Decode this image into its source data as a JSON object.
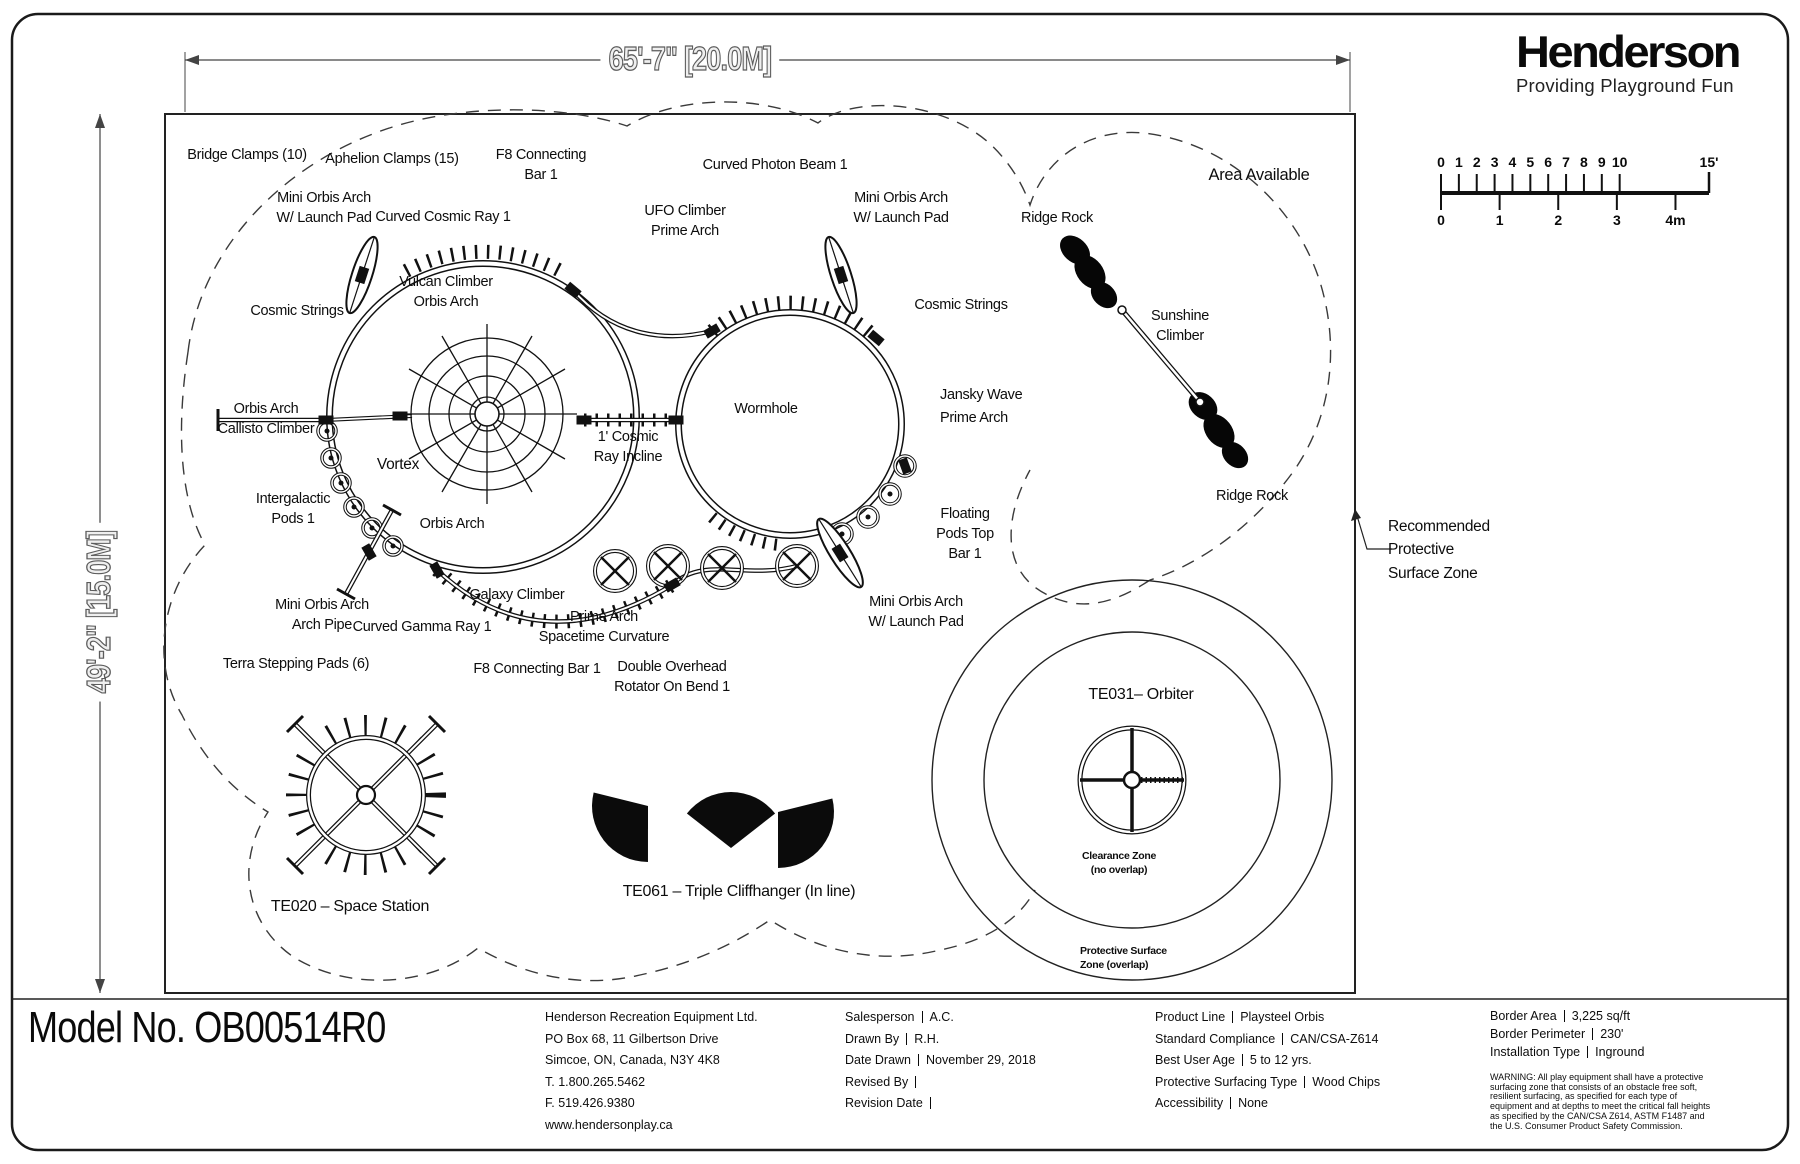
{
  "window": {
    "model_no": "Model No. OB00514R0"
  },
  "logo": {
    "name": "Henderson",
    "tagline": "Providing Playground Fun"
  },
  "dimensions": {
    "width": "65'-7\" [20.0M]",
    "height": "49'-2\" [15.0M]"
  },
  "scale_bar": {
    "feet": [
      "0",
      "1",
      "2",
      "3",
      "4",
      "5",
      "6",
      "7",
      "8",
      "9",
      "10"
    ],
    "feet_far": "15'",
    "meters": [
      "0",
      "1",
      "2",
      "3",
      "4m"
    ]
  },
  "plan": {
    "labels": [
      {
        "text": "Bridge Clamps (10)",
        "x": 247,
        "y": 145
      },
      {
        "text": "Aphelion Clamps (15)",
        "x": 392,
        "y": 149
      },
      {
        "text": "F8 Connecting\nBar 1",
        "x": 541,
        "y": 145
      },
      {
        "text": "Curved Photon Beam 1",
        "x": 775,
        "y": 155
      },
      {
        "text": "Mini Orbis Arch\nW/ Launch Pad",
        "x": 324,
        "y": 188
      },
      {
        "text": "Curved Cosmic Ray 1",
        "x": 443,
        "y": 207
      },
      {
        "text": "UFO Climber\nPrime Arch",
        "x": 685,
        "y": 201
      },
      {
        "text": "Mini Orbis Arch\nW/ Launch Pad",
        "x": 901,
        "y": 188
      },
      {
        "text": "Ridge Rock",
        "x": 1057,
        "y": 208
      },
      {
        "text": "Area Available",
        "x": 1259,
        "y": 164,
        "size": 16.5
      },
      {
        "text": "Vulcan Climber\nOrbis Arch",
        "x": 446,
        "y": 272
      },
      {
        "text": "Cosmic Strings",
        "x": 297,
        "y": 301
      },
      {
        "text": "Cosmic Strings",
        "x": 961,
        "y": 295
      },
      {
        "text": "Sunshine\nClimber",
        "x": 1180,
        "y": 306
      },
      {
        "text": "Wormhole",
        "x": 766,
        "y": 399
      },
      {
        "text": "Jansky Wave\nPrime Arch",
        "x": 940,
        "y": 384,
        "align": "left",
        "lh": 1.62
      },
      {
        "text": "Orbis Arch\nCallisto Climber",
        "x": 266,
        "y": 399
      },
      {
        "text": "1' Cosmic\nRay Incline",
        "x": 628,
        "y": 427
      },
      {
        "text": "Vortex",
        "x": 398,
        "y": 454,
        "size": 15.5
      },
      {
        "text": "Ridge Rock",
        "x": 1252,
        "y": 486
      },
      {
        "text": "Intergalactic\nPods 1",
        "x": 293,
        "y": 489
      },
      {
        "text": "Orbis Arch",
        "x": 452,
        "y": 514
      },
      {
        "text": "Floating\nPods Top\nBar 1",
        "x": 965,
        "y": 504
      },
      {
        "text": "Recommended\nProtective\nSurface Zone",
        "x": 1388,
        "y": 515,
        "align": "left",
        "size": 15.5,
        "lh": 1.5
      },
      {
        "text": "Mini Orbis Arch\nArch Pipe",
        "x": 322,
        "y": 595
      },
      {
        "text": "Galaxy Climber",
        "x": 517,
        "y": 585
      },
      {
        "text": "Curved Gamma Ray 1",
        "x": 422,
        "y": 617
      },
      {
        "text": "Prime Arch\nSpacetime Curvature",
        "x": 604,
        "y": 607
      },
      {
        "text": "Mini Orbis Arch\nW/ Launch Pad",
        "x": 916,
        "y": 592
      },
      {
        "text": "Terra Stepping Pads (6)",
        "x": 296,
        "y": 654
      },
      {
        "text": "F8 Connecting Bar 1",
        "x": 537,
        "y": 659
      },
      {
        "text": "Double Overhead\nRotator On Bend 1",
        "x": 672,
        "y": 657
      },
      {
        "text": "TE031– Orbiter",
        "x": 1141,
        "y": 684,
        "size": 16
      },
      {
        "text": "TE020 – Space Station",
        "x": 350,
        "y": 896,
        "size": 16
      },
      {
        "text": "TE061 – Triple Cliffhanger (In line)",
        "x": 739,
        "y": 881,
        "size": 16
      },
      {
        "text": "Clearance Zone\n(no overlap)",
        "x": 1119,
        "y": 849,
        "size": 10.5,
        "bold": true
      },
      {
        "text": "Protective Surface\nZone (overlap)",
        "x": 1080,
        "y": 944,
        "size": 10.5,
        "bold": true,
        "align": "left"
      }
    ]
  },
  "title_block": {
    "company_lines": [
      "Henderson Recreation Equipment Ltd.",
      "PO Box 68, 11 Gilbertson Drive",
      "Simcoe, ON, Canada, N3Y 4K8",
      "T. 1.800.265.5462",
      "F. 519.426.9380",
      "www.hendersonplay.ca"
    ],
    "project_rows": [
      {
        "label": "Salesperson",
        "value": "A.C."
      },
      {
        "label": "Drawn By",
        "value": "R.H."
      },
      {
        "label": "Date Drawn",
        "value": "November 29, 2018"
      },
      {
        "label": "Revised By",
        "value": ""
      },
      {
        "label": "Revision Date",
        "value": ""
      }
    ],
    "product_rows": [
      {
        "label": "Product Line",
        "value": "Playsteel Orbis"
      },
      {
        "label": "Standard Compliance",
        "value": "CAN/CSA-Z614"
      },
      {
        "label": "Best User Age",
        "value": "5 to 12 yrs."
      },
      {
        "label": "Protective Surfacing Type",
        "value": "Wood Chips"
      },
      {
        "label": "Accessibility",
        "value": "None"
      }
    ],
    "site_rows": [
      {
        "label": "Border Area",
        "value": "3,225 sq/ft"
      },
      {
        "label": "Border Perimeter",
        "value": "230'"
      },
      {
        "label": "Installation Type",
        "value": "Inground"
      }
    ],
    "warning": "WARNING: All play equipment shall have a protective surfacing zone that consists of an obstacle free soft, resilient surfacing, as specified for each type of equipment and at depths to meet the critical fall heights as specified by the CAN/CSA Z614, ASTM F1487 and the U.S. Consumer Product Safety Commission."
  }
}
